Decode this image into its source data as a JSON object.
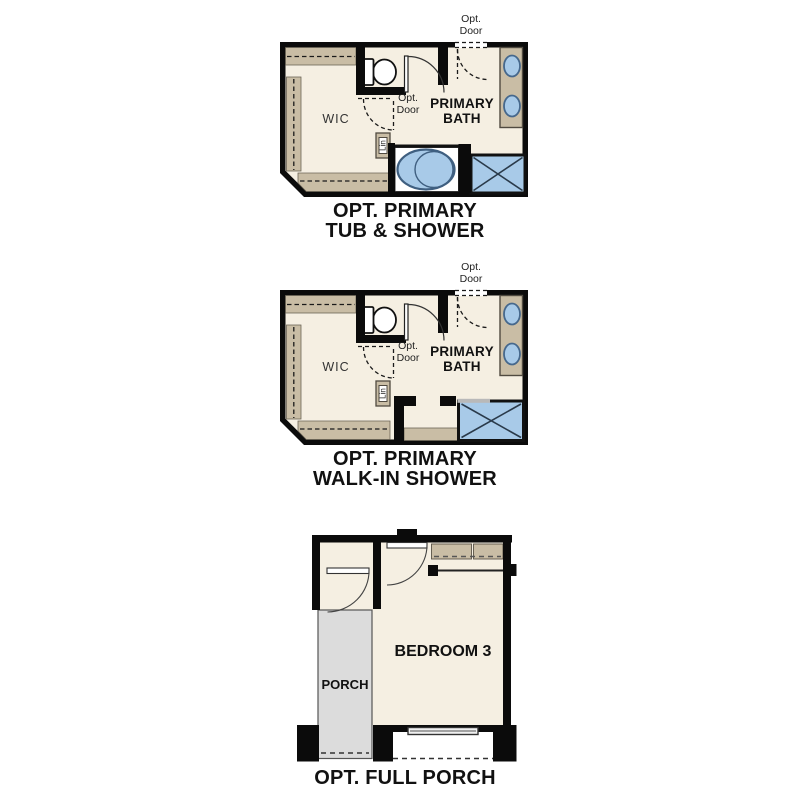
{
  "page": {
    "background": "#ffffff",
    "title": "Floor plan options"
  },
  "colors": {
    "wall": "#0b0b0b",
    "floor": "#f5efe2",
    "casework_tan": "#c9bda5",
    "fixture_blue": "#a8cae8",
    "fixture_blue_stroke": "#3f5f80",
    "porch_gray": "#dcdcdc",
    "text_dark": "#111111",
    "text_muted": "#2e2e2e"
  },
  "plans": [
    {
      "name": "opt-primary-tub-and-shower",
      "caption": {
        "line1": "OPT. PRIMARY",
        "line2": "TUB & SHOWER"
      },
      "labels": {
        "wic": "WIC",
        "bath_line1": "PRIMARY",
        "bath_line2": "BATH",
        "linen": "Lin",
        "opt_door_top": {
          "line1": "Opt.",
          "line2": "Door"
        },
        "opt_door_mid": {
          "line1": "Opt.",
          "line2": "Door"
        }
      },
      "fixtures": [
        "toilet",
        "double-sink-vanity",
        "oval-tub",
        "shower"
      ]
    },
    {
      "name": "opt-primary-walk-in-shower",
      "caption": {
        "line1": "OPT. PRIMARY",
        "line2": "WALK-IN SHOWER"
      },
      "labels": {
        "wic": "WIC",
        "bath_line1": "PRIMARY",
        "bath_line2": "BATH",
        "linen": "Lin",
        "opt_door_top": {
          "line1": "Opt.",
          "line2": "Door"
        },
        "opt_door_mid": {
          "line1": "Opt.",
          "line2": "Door"
        }
      },
      "fixtures": [
        "toilet",
        "double-sink-vanity",
        "walk-in-shower"
      ]
    },
    {
      "name": "opt-full-porch",
      "caption": {
        "line1": "OPT. FULL PORCH"
      },
      "labels": {
        "bedroom": "BEDROOM 3",
        "porch": "PORCH"
      },
      "fixtures": [
        "closet-shelves",
        "window",
        "entry-door",
        "bedroom-door"
      ]
    }
  ]
}
